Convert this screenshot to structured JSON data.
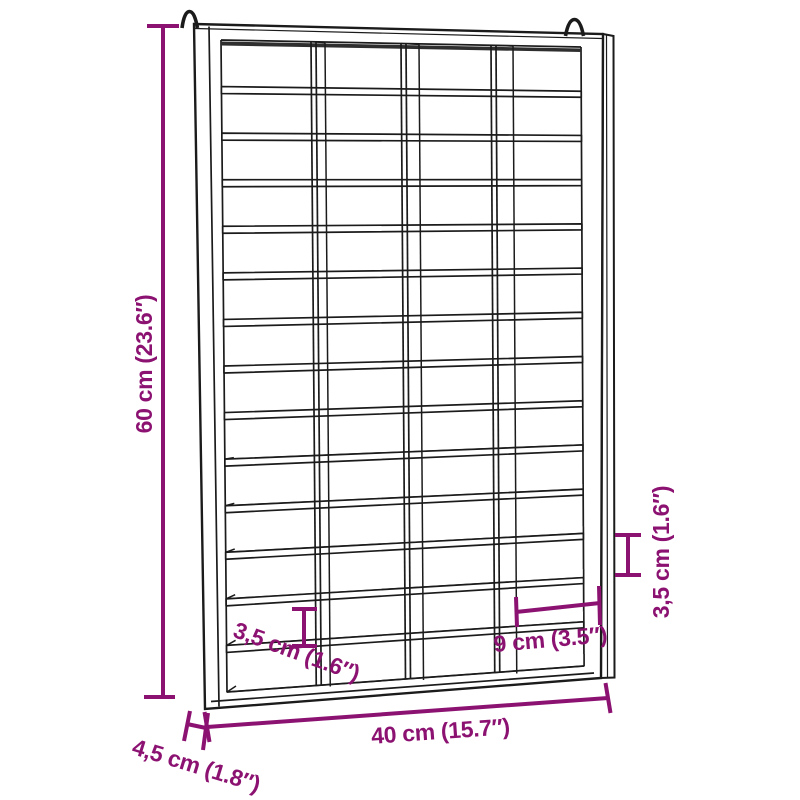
{
  "diagram": {
    "type": "product-dimension-drawing",
    "product": "wall-mounted pigeonhole compartment shelf with two hanging hooks",
    "background_color": "#ffffff",
    "line_color": "#1b1b1b",
    "dimension_color": "#8C1272",
    "structure": {
      "rows": 14,
      "columns": 4,
      "compartments": 56,
      "hooks": 2
    },
    "dimensions": {
      "height": {
        "label": "60 cm (23.6″)",
        "cm": "60",
        "inches": "23.6"
      },
      "width": {
        "label": "40 cm (15.7″)",
        "cm": "40",
        "inches": "15.7"
      },
      "depth": {
        "label": "4,5 cm (1.8″)",
        "cm": "4,5",
        "inches": "1.8"
      },
      "compartment_width": {
        "label": "9 cm (3.5″)",
        "cm": "9",
        "inches": "3.5"
      },
      "compartment_height_left": {
        "label": "3,5 cm (1.6″)",
        "cm": "3,5",
        "inches": "1.6"
      },
      "compartment_height_right": {
        "label": "3,5 cm (1.6″)",
        "cm": "3,5",
        "inches": "1.6"
      }
    }
  }
}
